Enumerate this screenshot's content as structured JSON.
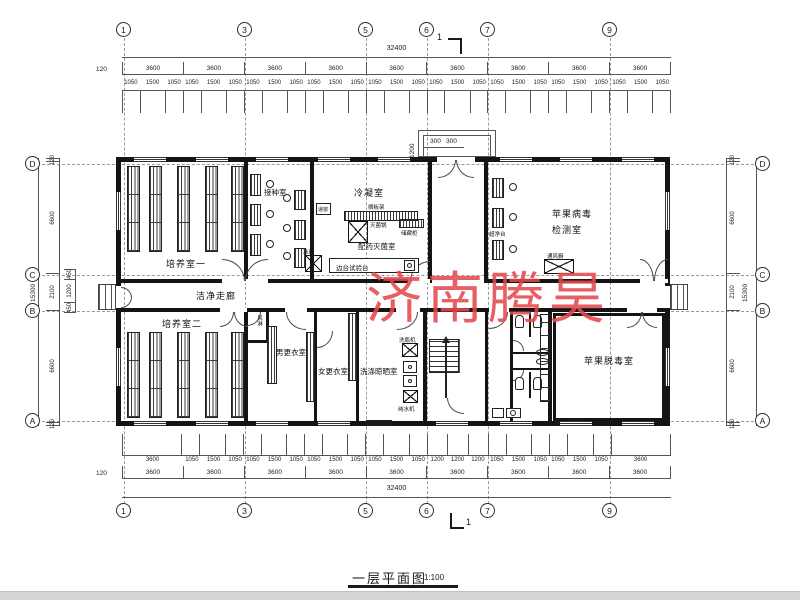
{
  "watermark": {
    "text": "济南腾昊",
    "color": "#e4484e"
  },
  "title_block": {
    "name": "一层平面图",
    "scale": "1:100"
  },
  "grid": {
    "top": [
      "1",
      "3",
      "5",
      "6",
      "7",
      "9"
    ],
    "bottom": [
      "1",
      "3",
      "5",
      "6",
      "7",
      "9"
    ],
    "left": [
      "D",
      "C",
      "B",
      "A"
    ],
    "right": [
      "D",
      "C",
      "B",
      "A"
    ]
  },
  "dims": {
    "top": {
      "overall": "32400",
      "offset": "120",
      "bays": [
        "3600",
        "3600",
        "3600",
        "3600",
        "3600",
        "3600",
        "3600",
        "3600",
        "3600"
      ],
      "fine": [
        "1050",
        "1500",
        "1050",
        "1050",
        "1500",
        "1050",
        "1050",
        "1500",
        "1050",
        "1050",
        "1500",
        "1050",
        "1050",
        "1500",
        "1050",
        "1050",
        "1500",
        "1050",
        "1050",
        "1500",
        "1050",
        "1050",
        "1500",
        "1050",
        "1050",
        "1500",
        "1050"
      ]
    },
    "bottom": {
      "overall": "32400",
      "offset": "120",
      "bays": [
        "3600",
        "3600",
        "3600",
        "3600",
        "3600",
        "3600",
        "3600",
        "3600",
        "3600"
      ],
      "fine": [
        "3600",
        "1050",
        "1500",
        "1050",
        "1050",
        "1500",
        "1050",
        "1050",
        "1500",
        "1050",
        "1050",
        "1500",
        "1050",
        "1200",
        "1200",
        "1200",
        "1050",
        "1500",
        "1050",
        "1050",
        "1500",
        "1050",
        "3600"
      ]
    },
    "left": {
      "overall": "15300",
      "chain": [
        "120",
        "6600",
        "2100",
        "6600",
        "120"
      ],
      "inner": [
        "450",
        "1200",
        "450"
      ]
    },
    "right": {
      "overall": "15300",
      "chain": [
        "120",
        "6600",
        "2100",
        "6600",
        "120"
      ]
    },
    "entrance": {
      "depth": "1200",
      "a": "300",
      "b": "300"
    },
    "section": "1"
  },
  "rooms": {
    "culture1": "培养室一",
    "inoculation": "接种室",
    "condense": "冷凝室",
    "prep": "配药灭菌室",
    "virus_line1": "苹果病毒",
    "virus_line2": "检测室",
    "corridor": "洁净走廊",
    "culture2": "培养室二",
    "men_change": "男更衣室",
    "women_change": "女更衣室",
    "washing": "洗涤晾晒室",
    "detox": "苹果脱毒室",
    "air_shower": "风淋"
  },
  "equipment": {
    "pass_window": "递窗",
    "shelf": "搁板架",
    "sterilizer": "灭菌锅",
    "cabinet": "储藏柜",
    "fridge": "冰箱",
    "side_bench": "边台试验台",
    "clean_bench": "超净台",
    "fume_hood": "通风橱",
    "bottle_washer": "洗瓶机",
    "water_machine": "纯水机"
  }
}
